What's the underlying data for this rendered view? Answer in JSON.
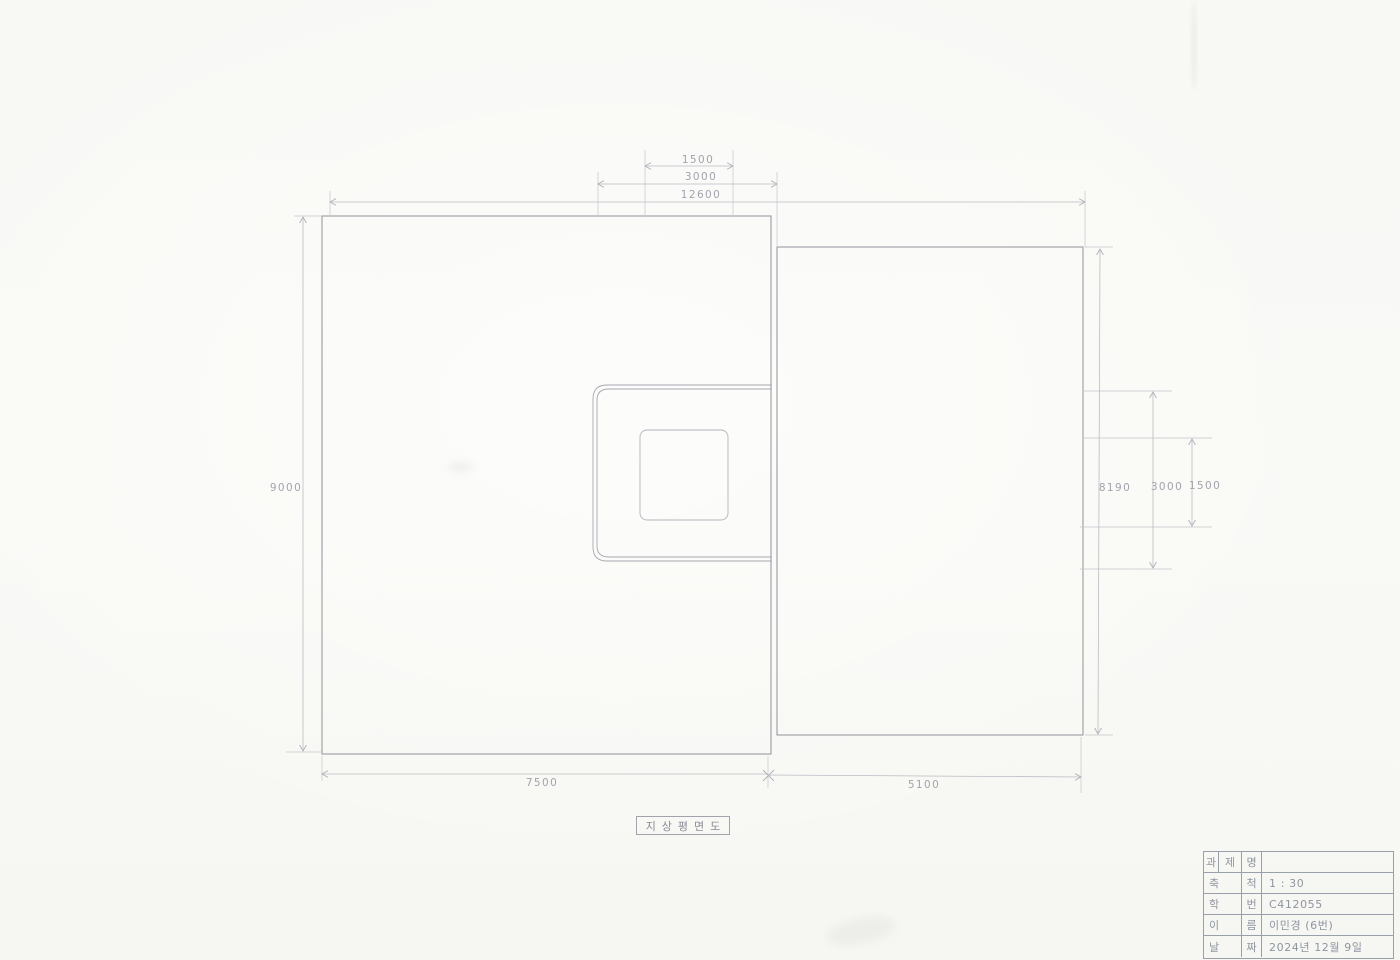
{
  "sheet": {
    "drawing_title": "지상평면도",
    "dims": {
      "top_inner": "1500",
      "top_mid": "3000",
      "top_total": "12600",
      "left_total": "9000",
      "bottom_left": "7500",
      "bottom_right": "5100",
      "right_total": "8190",
      "right_mid": "3000",
      "right_inner": "1500"
    }
  },
  "title_block": {
    "rows": [
      {
        "c1": "과",
        "c2": "제",
        "c3": "명",
        "value": ""
      },
      {
        "c1": "축",
        "c2": "척",
        "value": "1 : 30"
      },
      {
        "c1": "학",
        "c2": "번",
        "value": "C412055"
      },
      {
        "c1": "이",
        "c2": "름",
        "value": "이민경 (6번)"
      },
      {
        "c1": "날",
        "c2": "짜",
        "value": "2024년 12월 9일"
      }
    ]
  },
  "colors": {
    "paper": "#f8f8f5",
    "outline": "#9c9ca4",
    "dimension_line": "#bcbcc4",
    "pencil_text": "#a3a3ae",
    "title_block_line": "#9aa0ab"
  }
}
